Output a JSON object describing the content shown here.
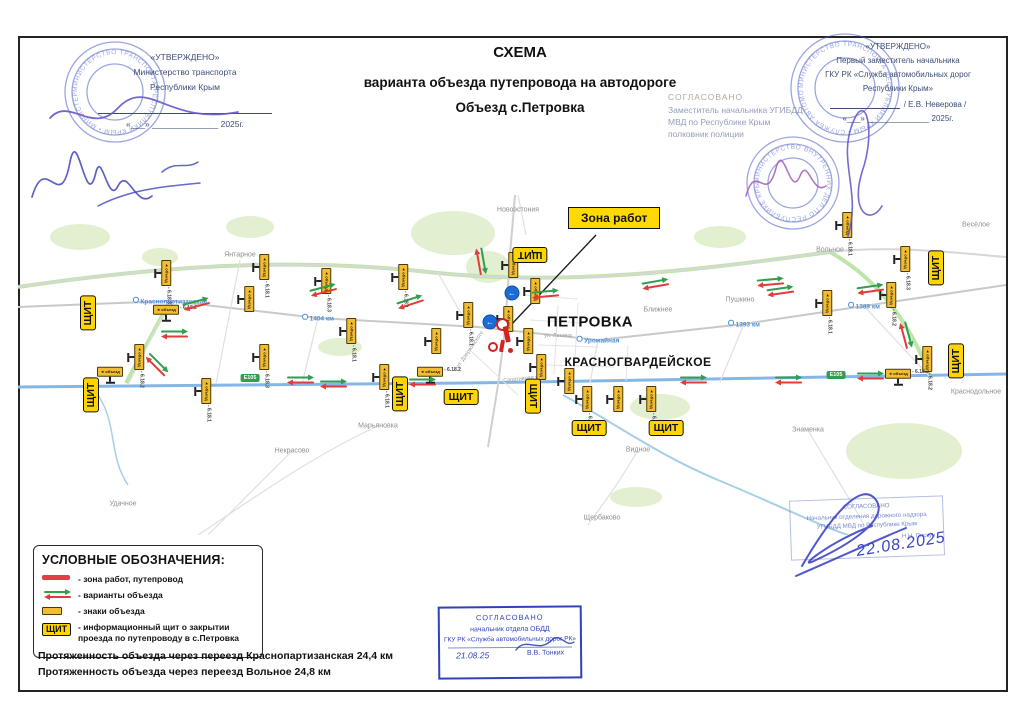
{
  "doc": {
    "title1": "СХЕМА",
    "title2": "варианта объезда путепровода на автодороге",
    "title3": "Объезд с.Петровка"
  },
  "approve_left": {
    "l1": "«УТВЕРЖДЕНО»",
    "l2": "Министерство транспорта",
    "l3": "Республики Крым",
    "date": "«___» ______________ 2025г."
  },
  "approve_right": {
    "l1": "«УТВЕРЖДЕНО»",
    "l2": "Первый заместитель начальника",
    "l3": "ГКУ РК «Служба автомобильных дорог",
    "l4": "Республики Крым»",
    "sign": "/ Е.В. Неверова /",
    "date": "«___» ______________ 2025г."
  },
  "gibdd": {
    "l1": "СОГЛАСОВАНО",
    "l2": "Заместитель начальника УГИБДД",
    "l3": "МВД по Республике Крым",
    "l4": "полковник полиции"
  },
  "stamp_bottom_center": {
    "l1": "СОГЛАСОВАНО",
    "l2": "начальник отдела ОБДД",
    "l3": "ГКУ РК «Служба автомобильных дорог РК»",
    "date": "21.08.25",
    "name": "В.В. Тонких"
  },
  "stamp_bottom_right": {
    "l1": "СОГЛАСОВАНО",
    "l2": "Начальник отделения дорожного надзора",
    "l3": "УГИБДД МВД по Республике Крым",
    "name": "Н.Н. Пискун",
    "date": "22.08.2025"
  },
  "legend": {
    "title": "УСЛОВНЫЕ ОБОЗНАЧЕНИЯ:",
    "item1": "- зона работ, путепровод",
    "item2": "- варианты объезда",
    "item3": "- знаки объезда",
    "item4a": "- информационный щит о закрытии",
    "item4b": "проезда по путепроводу в с.Петровка",
    "shield": "ЩИТ"
  },
  "footer": {
    "line1": "Протяженность объезда через переезд Краснопартизанская 24,4 км",
    "line2": "Протяженность объезда через переезд Вольное 24,8 км"
  },
  "stamps_round": [
    {
      "x": 115,
      "y": 92,
      "r": 50,
      "ring": "МИНИСТЕРСТВО ТРАНСПОРТА РЕСПУБЛИКИ КРЫМ • МИНИСТЕРСТВО ТРАНСПОРТА •"
    },
    {
      "x": 845,
      "y": 88,
      "r": 54,
      "ring": "МИНИСТЕРСТВО ТРАНСПОРТА РЕСПУБЛИКИ КРЫМ • СЛУЖБА АВТОМОБИЛЬНЫХ ДОРОГ •"
    },
    {
      "x": 793,
      "y": 183,
      "r": 46,
      "ring": "МИНИСТЕРСТВО ВНУТРЕННИХ ДЕЛ ПО РЕСПУБЛИКЕ КРЫМ • МВД •"
    }
  ],
  "map": {
    "callout": "Зона работ",
    "shield": "ЩИТ",
    "sign_text": "◄ объезд",
    "road_badge": "Е105",
    "towns": [
      {
        "n": "ПЕТРОВКА",
        "x": 572,
        "y": 127,
        "size": 15
      },
      {
        "n": "КРАСНОГВАРДЕЙСКОЕ",
        "x": 620,
        "y": 167,
        "size": 12
      }
    ],
    "places": [
      {
        "n": "Новоэстония",
        "x": 500,
        "y": 15
      },
      {
        "n": "Янтарное",
        "x": 222,
        "y": 60
      },
      {
        "n": "Вольное",
        "x": 812,
        "y": 55
      },
      {
        "n": "Весёлое",
        "x": 958,
        "y": 30
      },
      {
        "n": "Пушкино",
        "x": 722,
        "y": 105
      },
      {
        "n": "Ближнее",
        "x": 640,
        "y": 115
      },
      {
        "n": "Краснодольное",
        "x": 958,
        "y": 197
      },
      {
        "n": "Знаменка",
        "x": 790,
        "y": 235
      },
      {
        "n": "Видное",
        "x": 620,
        "y": 255
      },
      {
        "n": "Марьяновка",
        "x": 360,
        "y": 231
      },
      {
        "n": "Некрасово",
        "x": 274,
        "y": 256
      },
      {
        "n": "Щербаково",
        "x": 584,
        "y": 323
      },
      {
        "n": "Удачное",
        "x": 105,
        "y": 309
      }
    ],
    "stations": [
      {
        "n": "Краснопартизанская",
        "x": 152,
        "y": 106
      },
      {
        "n": "1404 км",
        "x": 300,
        "y": 123
      },
      {
        "n": "Урожайная",
        "x": 580,
        "y": 145
      },
      {
        "n": "1393 км",
        "x": 726,
        "y": 129
      },
      {
        "n": "1389 км",
        "x": 846,
        "y": 111
      }
    ],
    "streets": [
      {
        "n": "ул. Ленина",
        "x": 540,
        "y": 141,
        "rot": 0
      },
      {
        "n": "ул. Дзержинского",
        "x": 452,
        "y": 155,
        "rot": -55
      },
      {
        "n": "Спортивная ул.",
        "x": 505,
        "y": 184,
        "rot": -6
      }
    ],
    "shields": [
      {
        "x": 70,
        "y": 118,
        "rot": -90
      },
      {
        "x": 73,
        "y": 200,
        "rot": -90
      },
      {
        "x": 382,
        "y": 199,
        "rot": -90
      },
      {
        "x": 512,
        "y": 60,
        "rot": 180
      },
      {
        "x": 515,
        "y": 201,
        "rot": 90
      },
      {
        "x": 443,
        "y": 202,
        "rot": 0
      },
      {
        "x": 571,
        "y": 233,
        "rot": 0
      },
      {
        "x": 648,
        "y": 233,
        "rot": 0
      },
      {
        "x": 918,
        "y": 73,
        "rot": -90
      },
      {
        "x": 938,
        "y": 166,
        "rot": -90
      }
    ],
    "signs": [
      {
        "x": 145,
        "y": 78,
        "rot": 90,
        "code": "6.18.3"
      },
      {
        "x": 243,
        "y": 72,
        "rot": 90,
        "code": "6.18.1"
      },
      {
        "x": 228,
        "y": 104,
        "rot": 90,
        "code": ""
      },
      {
        "x": 148,
        "y": 118,
        "rot": 0,
        "code": "6.18.2"
      },
      {
        "x": 118,
        "y": 162,
        "rot": 90,
        "code": "6.18.2"
      },
      {
        "x": 243,
        "y": 162,
        "rot": 90,
        "code": "6.18.3"
      },
      {
        "x": 92,
        "y": 180,
        "rot": 0,
        "code": ""
      },
      {
        "x": 185,
        "y": 196,
        "rot": 90,
        "code": "6.18.1"
      },
      {
        "x": 305,
        "y": 86,
        "rot": 90,
        "code": "6.18.3"
      },
      {
        "x": 382,
        "y": 82,
        "rot": 90,
        "code": "6.18.1"
      },
      {
        "x": 330,
        "y": 136,
        "rot": 90,
        "code": "6.18.1"
      },
      {
        "x": 415,
        "y": 146,
        "rot": 90,
        "code": ""
      },
      {
        "x": 363,
        "y": 182,
        "rot": 90,
        "code": "6.18.1"
      },
      {
        "x": 412,
        "y": 180,
        "rot": 0,
        "code": "6.18.2"
      },
      {
        "x": 447,
        "y": 120,
        "rot": 90,
        "code": "6.18.1"
      },
      {
        "x": 492,
        "y": 70,
        "rot": 90,
        "code": ""
      },
      {
        "x": 514,
        "y": 96,
        "rot": 90,
        "code": ""
      },
      {
        "x": 487,
        "y": 124,
        "rot": 90,
        "code": ""
      },
      {
        "x": 507,
        "y": 146,
        "rot": 90,
        "code": ""
      },
      {
        "x": 520,
        "y": 172,
        "rot": 90,
        "code": ""
      },
      {
        "x": 548,
        "y": 186,
        "rot": 90,
        "code": ""
      },
      {
        "x": 566,
        "y": 204,
        "rot": 90,
        "code": "6.18.1"
      },
      {
        "x": 597,
        "y": 204,
        "rot": 90,
        "code": ""
      },
      {
        "x": 630,
        "y": 204,
        "rot": 90,
        "code": "6.18.1"
      },
      {
        "x": 806,
        "y": 108,
        "rot": 90,
        "code": "6.18.1"
      },
      {
        "x": 870,
        "y": 100,
        "rot": 90,
        "code": "6.18.2"
      },
      {
        "x": 884,
        "y": 64,
        "rot": 90,
        "code": "6.18.3"
      },
      {
        "x": 826,
        "y": 30,
        "rot": 90,
        "code": "6.18.1"
      },
      {
        "x": 906,
        "y": 164,
        "rot": 90,
        "code": "6.18.2"
      },
      {
        "x": 880,
        "y": 182,
        "rot": 0,
        "code": "6.18.2"
      }
    ],
    "arrows": [
      {
        "x": 178,
        "y": 110,
        "rot": -15
      },
      {
        "x": 156,
        "y": 140,
        "rot": 0
      },
      {
        "x": 138,
        "y": 170,
        "rot": 45
      },
      {
        "x": 282,
        "y": 186,
        "rot": 0
      },
      {
        "x": 305,
        "y": 96,
        "rot": -15
      },
      {
        "x": 392,
        "y": 108,
        "rot": -18
      },
      {
        "x": 527,
        "y": 100,
        "rot": -5
      },
      {
        "x": 637,
        "y": 90,
        "rot": -10
      },
      {
        "x": 752,
        "y": 88,
        "rot": -5
      },
      {
        "x": 675,
        "y": 186,
        "rot": 0
      },
      {
        "x": 770,
        "y": 186,
        "rot": 0
      },
      {
        "x": 762,
        "y": 97,
        "rot": -8
      },
      {
        "x": 852,
        "y": 95,
        "rot": -8
      },
      {
        "x": 887,
        "y": 140,
        "rot": 75
      },
      {
        "x": 852,
        "y": 182,
        "rot": 0
      },
      {
        "x": 315,
        "y": 190,
        "rot": 0
      },
      {
        "x": 404,
        "y": 188,
        "rot": 0
      },
      {
        "x": 462,
        "y": 66,
        "rot": 80
      }
    ],
    "blue_signs": [
      {
        "x": 494,
        "y": 98
      },
      {
        "x": 472,
        "y": 127
      }
    ],
    "road_badges": [
      {
        "x": 232,
        "y": 183
      },
      {
        "x": 818,
        "y": 180
      }
    ],
    "workzone": {
      "x": 488,
      "y": 145
    }
  }
}
